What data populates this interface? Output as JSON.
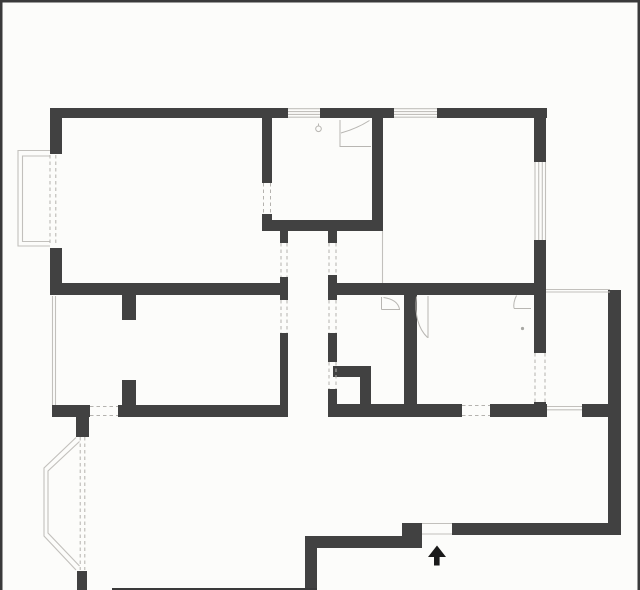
{
  "plan": {
    "title": "apartment-floor-plan",
    "canvas": {
      "w": 640,
      "h": 590,
      "bg": "#fcfcfa"
    },
    "colors": {
      "wall": "#414141",
      "frame": "#3a3a3a",
      "thin": "#c2c0bc",
      "dash": "#b4b2ae",
      "symbol": "#b8b6b2",
      "arrow": "#1a1a1a",
      "dot": "#a8a8a4"
    },
    "frame_lines": [
      [
        0,
        0,
        640,
        2.5,
        "frame-top"
      ],
      [
        0,
        0,
        2.5,
        590,
        "frame-left"
      ],
      [
        637.5,
        0,
        2.5,
        590,
        "frame-right"
      ],
      [
        112,
        588,
        205,
        2,
        "frame-bottom-partial"
      ]
    ],
    "walls": [
      [
        50,
        108,
        238,
        10,
        "wall-top-a"
      ],
      [
        320,
        108,
        74,
        10,
        "wall-top-b"
      ],
      [
        437,
        108,
        110,
        10,
        "wall-top-c"
      ],
      [
        50,
        108,
        12,
        46,
        "wall-left-upper"
      ],
      [
        50,
        248,
        12,
        47,
        "wall-left-lower"
      ],
      [
        262,
        118,
        10,
        65,
        "wall-kitchen-left-upper"
      ],
      [
        262,
        214,
        10,
        17,
        "wall-kitchen-left-lower"
      ],
      [
        372,
        118,
        11,
        113,
        "wall-kitchen-right"
      ],
      [
        262,
        220,
        121,
        11,
        "wall-kitchen-bottom"
      ],
      [
        534,
        118,
        12,
        44,
        "wall-topright-room-upper"
      ],
      [
        534,
        240,
        12,
        55,
        "wall-topright-room-lower"
      ],
      [
        52,
        283,
        235,
        12,
        "wall-divider-left"
      ],
      [
        328,
        283,
        218,
        12,
        "wall-divider-right"
      ],
      [
        280,
        230,
        8,
        13,
        "wall-corridor-left-a"
      ],
      [
        280,
        277,
        8,
        23,
        "wall-corridor-left-b"
      ],
      [
        280,
        333,
        8,
        79,
        "wall-corridor-left-c"
      ],
      [
        328,
        231,
        9,
        12,
        "wall-corridor-right-a"
      ],
      [
        328,
        275,
        9,
        25,
        "wall-corridor-right-b"
      ],
      [
        328,
        333,
        9,
        29,
        "wall-corridor-right-c"
      ],
      [
        328,
        389,
        9,
        28,
        "wall-corridor-right-d"
      ],
      [
        333,
        366,
        38,
        11,
        "wall-alcove-top"
      ],
      [
        360,
        377,
        11,
        28,
        "wall-alcove-right"
      ],
      [
        404,
        295,
        13,
        110,
        "wall-bottom-middle-vertical"
      ],
      [
        534,
        295,
        12,
        58,
        "wall-right-vertical-upper"
      ],
      [
        534,
        402,
        12,
        15,
        "wall-right-vertical-lower"
      ],
      [
        52,
        405,
        38,
        12,
        "wall-bottom-a"
      ],
      [
        118,
        405,
        170,
        12,
        "wall-bottom-b"
      ],
      [
        328,
        404,
        134,
        13,
        "wall-bottom-c"
      ],
      [
        490,
        404,
        57,
        13,
        "wall-bottom-d"
      ],
      [
        582,
        404,
        39,
        13,
        "wall-bottom-e"
      ],
      [
        76,
        417,
        13,
        20,
        "wall-bay-stub-top"
      ],
      [
        77,
        571,
        10,
        19,
        "wall-bay-stub-bottom"
      ],
      [
        122,
        295,
        14,
        25,
        "wall-partition-stub-a"
      ],
      [
        122,
        380,
        14,
        25,
        "wall-partition-stub-b"
      ],
      [
        608,
        290,
        13,
        245,
        "wall-outer-right"
      ],
      [
        452,
        523,
        156,
        12,
        "wall-entry-right"
      ],
      [
        402,
        523,
        20,
        25,
        "wall-entry-step"
      ],
      [
        305,
        536,
        97,
        12,
        "wall-entry-left"
      ],
      [
        305,
        536,
        12,
        54,
        "wall-entry-down"
      ]
    ],
    "thin_lines": [
      [
        288,
        108.7,
        320,
        108.7,
        "window-top-kitchen"
      ],
      [
        288,
        111.6,
        320,
        111.6,
        "window-top-kitchen"
      ],
      [
        288,
        114.4,
        320,
        114.4,
        "window-top-kitchen"
      ],
      [
        288,
        117.2,
        320,
        117.2,
        "window-top-kitchen"
      ],
      [
        394,
        108.7,
        437,
        108.7,
        "window-top-bedroom"
      ],
      [
        394,
        111.6,
        437,
        111.6,
        "window-top-bedroom"
      ],
      [
        394,
        114.4,
        437,
        114.4,
        "window-top-bedroom"
      ],
      [
        394,
        117.2,
        437,
        117.2,
        "window-top-bedroom"
      ],
      [
        535,
        162,
        535,
        240,
        "window-right-bedroom"
      ],
      [
        538.7,
        162,
        538.7,
        240,
        "window-right-bedroom"
      ],
      [
        542.3,
        162,
        542.3,
        240,
        "window-right-bedroom"
      ],
      [
        545.5,
        162,
        545.5,
        240,
        "window-right-bedroom"
      ],
      [
        547,
        406.5,
        582,
        406.5,
        "window-bottom"
      ],
      [
        547,
        409.8,
        582,
        409.8,
        "window-bottom"
      ],
      [
        546,
        289.5,
        610,
        289.5,
        "opening-line-entry"
      ],
      [
        546,
        292,
        610,
        292,
        "opening-line-entry"
      ],
      [
        422,
        523.5,
        452,
        523.5,
        "entry-door-gap-line"
      ],
      [
        422,
        534,
        452,
        534,
        "entry-door-gap-line"
      ],
      [
        52.5,
        296,
        52.5,
        405,
        "window-left-bedroom2"
      ],
      [
        55.5,
        296,
        55.5,
        405,
        "window-left-bedroom2"
      ],
      [
        382.5,
        231,
        382.5,
        283,
        "opening-line-kitchen-strip"
      ]
    ],
    "polylines": [
      {
        "name": "bay-window-outline-outer",
        "points": "50,150.5 18,150.5 18,246 50,246"
      },
      {
        "name": "bay-window-outline-inner",
        "points": "50,156 22.5,156 22.5,241.5 50,241.5"
      },
      {
        "name": "balcony-outline-outer",
        "points": "76,437.5 44,468 44,536 76,570"
      },
      {
        "name": "balcony-outline-inner",
        "points": "79.5,441.5 48,471 48,533 79.5,566"
      }
    ],
    "dashed_lines": [
      [
        50,
        155,
        50,
        246,
        "bay-window-opening"
      ],
      [
        55.8,
        155,
        55.8,
        246,
        "bay-window-opening"
      ],
      [
        80.2,
        437,
        80.2,
        570,
        "balcony-opening"
      ],
      [
        84.8,
        437,
        84.8,
        570,
        "balcony-opening"
      ],
      [
        263.5,
        183,
        263.5,
        214,
        "kitchen-door-opening"
      ],
      [
        270.5,
        183,
        270.5,
        214,
        "kitchen-door-opening"
      ],
      [
        281,
        243,
        281,
        277,
        "corridor-opening"
      ],
      [
        287,
        243,
        287,
        277,
        "corridor-opening"
      ],
      [
        281,
        300,
        281,
        333,
        "corridor-opening"
      ],
      [
        287,
        300,
        287,
        333,
        "corridor-opening"
      ],
      [
        329,
        243,
        329,
        275,
        "corridor-opening"
      ],
      [
        336,
        243,
        336,
        275,
        "corridor-opening"
      ],
      [
        329,
        300,
        329,
        333,
        "corridor-opening"
      ],
      [
        336,
        300,
        336,
        333,
        "corridor-opening"
      ],
      [
        329,
        362,
        329,
        389,
        "corridor-opening"
      ],
      [
        336,
        362,
        336,
        389,
        "corridor-opening"
      ],
      [
        90,
        406.5,
        118,
        406.5,
        "bedroom2-door-opening"
      ],
      [
        90,
        415.5,
        118,
        415.5,
        "bedroom2-door-opening"
      ],
      [
        462,
        405.5,
        490,
        405.5,
        "bottom-door-opening"
      ],
      [
        462,
        415.5,
        490,
        415.5,
        "bottom-door-opening"
      ],
      [
        535,
        353,
        535,
        402,
        "right-door-opening"
      ],
      [
        545,
        353,
        545,
        402,
        "right-door-opening"
      ]
    ],
    "symbol_paths": [
      {
        "name": "door-swing-kitchen",
        "d": "M340,120 L340,147 M340,146.5 L371,146.5 M341,133 Q357,128.5 369.5,120.5"
      },
      {
        "name": "door-swing-room-a",
        "d": "M381.5,297 L381.5,309.5 M381.5,309.5 L400,309.5 M383.5,297.5 Q397.5,299.5 399.5,309"
      },
      {
        "name": "door-swing-room-b",
        "d": "M428,296 L428,338 M416.5,296.5 Q413.5,324 427.5,337.5"
      },
      {
        "name": "door-swing-room-c",
        "d": "M514,308.5 L531,308.5 M516.5,295.5 Q513,302.5 514,308.3"
      },
      {
        "name": "kitchen-fixture-stem",
        "d": "M318.5,123.5 L318.5,126.5"
      }
    ],
    "circles": [
      {
        "name": "kitchen-fixture",
        "cx": 318.5,
        "cy": 128.8,
        "r": 2.8,
        "fill": "none"
      },
      {
        "name": "ceiling-dot",
        "cx": 522.5,
        "cy": 328.5,
        "r": 1.6,
        "fill": "#a8a8a4"
      }
    ],
    "entry_arrow": {
      "head": "428,557 446,557 437,545.5",
      "stem": [
        434,
        556.5,
        5.6,
        9
      ]
    }
  }
}
